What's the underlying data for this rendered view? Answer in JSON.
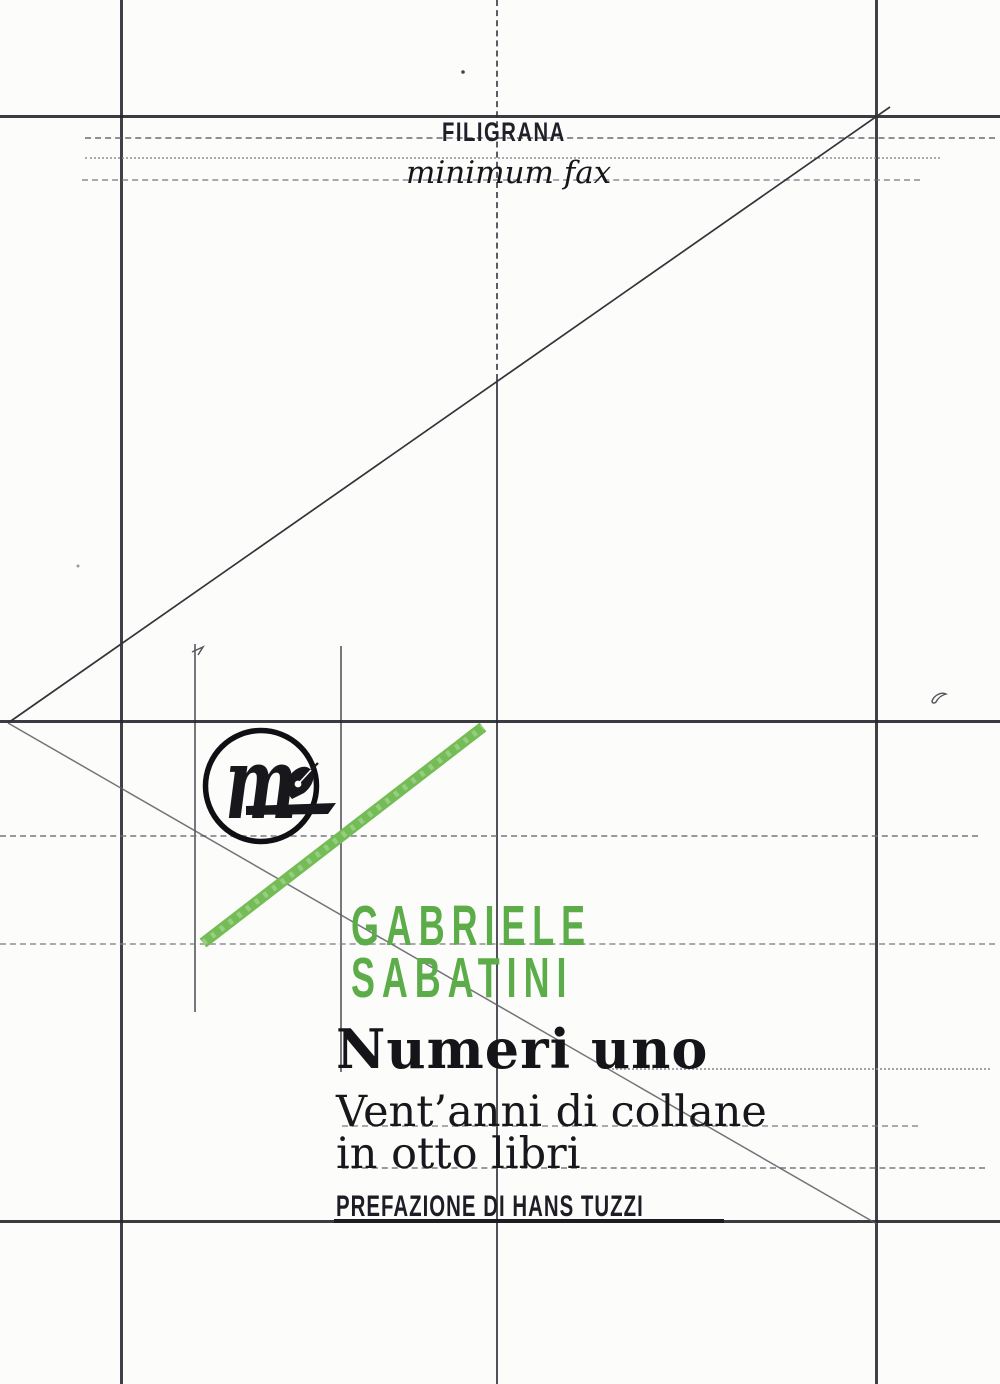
{
  "cover": {
    "series": "FILIGRANA",
    "publisher": "minimum fax",
    "author": {
      "line1": "GABRIELE",
      "line2": "SABATINI"
    },
    "title": "Numeri uno",
    "subtitle": {
      "line1": "Vent’anni di collane",
      "line2": "in otto libri"
    },
    "preface": "PREFAZIONE DI HANS TUZZI",
    "logo": {
      "letter": "m"
    }
  },
  "colors": {
    "green_text": "#5CAD49",
    "green_stroke": "#74BC55",
    "ink": "#17171c",
    "pencil_strong": "#26262e",
    "pencil_light": "#73737c",
    "paper": "#fcfcfa"
  }
}
